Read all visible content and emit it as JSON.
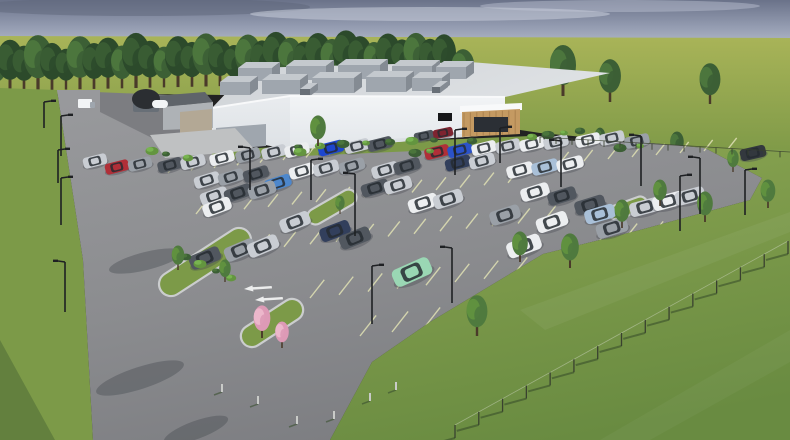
{
  "scene": {
    "type": "architectural-rendering",
    "description": "Aerial 3D rendering of a white single-story industrial building with rooftop HVAC units, a wood-clad entrance canopy, and a large landscaped parking lot filled with cars, surrounded by lawns, a tree line and fencing under an overcast blue-gray sky"
  },
  "palette": {
    "skyTop": "#6a7289",
    "skyMid": "#959db2",
    "skyHorizon": "#bac0cd",
    "cloudLight": "#c9cedb",
    "cloudDark": "#5d6579",
    "fieldLight": "#a9b458",
    "fieldMid": "#95a750",
    "fieldDark": "#7f9a48",
    "grassMid": "#7c9a48",
    "grassLight": "#8aa852",
    "hillTop": "#8aa451",
    "hillBottom": "#698b41",
    "grassShadow": "#4f6b36",
    "treeDark": "#2c4a2b",
    "treeMid": "#3c5f35",
    "treeLight": "#4f7a3e",
    "treeBright": "#63953f",
    "trunk": "#4a3a2a",
    "asphalt": "#8b8c8f",
    "asphaltLight": "#98999c",
    "asphaltDark": "#7c7d81",
    "curb": "#cbcdce",
    "stripe": "#dcddb2",
    "stripeWhite": "#eceded",
    "buildFront": "#f2f4f6",
    "buildFrontB": "#e2e6ea",
    "buildLeft": "#e9ecef",
    "buildLeftB": "#dde1e5",
    "roofA": "#cfd3d7",
    "roofB": "#dee1e4",
    "parapet": "#f8f9fa",
    "rtuFace": "#9fa6ae",
    "rtuTop": "#c4c9ce",
    "rtuSide": "#848b93",
    "rtuDark": "#686f77",
    "canopyWood": "#c49a62",
    "canopyWoodDark": "#a27a49",
    "glassDark": "#2b2f35",
    "signBlack": "#17181a",
    "domeDark": "#2b2e32",
    "annexGray": "#aeb2b6",
    "annexStone": "#b3a895",
    "annexRoof": "#5f646a",
    "padGray": "#bfc1c2",
    "pole": "#1e2023",
    "fence": "#39412f",
    "pinkLight": "#eebccf",
    "pinkMid": "#dd9ab6",
    "shadow": "#43464c"
  },
  "carColors": {
    "white": "#eceef0",
    "silver": "#c9cdd3",
    "gray": "#9aa0a7",
    "dkgray": "#51575f",
    "black": "#33383e",
    "navy": "#323f5c",
    "red": "#b02f38",
    "dkred": "#7e2430",
    "blue": "#2b52c8",
    "vividblue": "#1d46cf",
    "teal": "#4d87cc",
    "lightblue": "#a9c0d8",
    "mint": "#9ad7b4"
  },
  "building": {
    "rtus_back": [
      [
        238,
        68,
        34,
        13
      ],
      [
        286,
        66,
        40,
        14
      ],
      [
        338,
        65,
        42,
        14
      ],
      [
        392,
        66,
        40,
        14
      ],
      [
        436,
        67,
        30,
        12
      ]
    ],
    "rtus_front": [
      [
        220,
        82,
        30,
        13
      ],
      [
        262,
        80,
        38,
        14
      ],
      [
        312,
        78,
        42,
        15
      ],
      [
        366,
        77,
        40,
        15
      ],
      [
        412,
        78,
        30,
        13
      ]
    ],
    "vents": [
      [
        300,
        89,
        10,
        7
      ],
      [
        432,
        87,
        8,
        6
      ]
    ]
  },
  "parking": {
    "cars": [
      {
        "x": 95,
        "y": 161,
        "l": 24,
        "r": -14,
        "c": "silver"
      },
      {
        "x": 117,
        "y": 167,
        "l": 24,
        "r": -14,
        "c": "red"
      },
      {
        "x": 140,
        "y": 164,
        "l": 24,
        "r": -14,
        "c": "gray"
      },
      {
        "x": 170,
        "y": 165,
        "l": 25,
        "r": -15,
        "c": "dkgray"
      },
      {
        "x": 193,
        "y": 162,
        "l": 25,
        "r": -15,
        "c": "silver"
      },
      {
        "x": 222,
        "y": 158,
        "l": 25,
        "r": -15,
        "c": "white"
      },
      {
        "x": 248,
        "y": 155,
        "l": 25,
        "r": -15,
        "c": "gray"
      },
      {
        "x": 274,
        "y": 152,
        "l": 25,
        "r": -14,
        "c": "silver"
      },
      {
        "x": 297,
        "y": 150,
        "l": 25,
        "r": -14,
        "c": "white"
      },
      {
        "x": 331,
        "y": 148,
        "l": 26,
        "r": -14,
        "c": "vividblue"
      },
      {
        "x": 357,
        "y": 146,
        "l": 25,
        "r": -14,
        "c": "silver"
      },
      {
        "x": 380,
        "y": 144,
        "l": 25,
        "r": -14,
        "c": "dkgray"
      },
      {
        "x": 207,
        "y": 180,
        "l": 26,
        "r": -17,
        "c": "silver"
      },
      {
        "x": 231,
        "y": 177,
        "l": 26,
        "r": -17,
        "c": "gray"
      },
      {
        "x": 256,
        "y": 174,
        "l": 26,
        "r": -17,
        "c": "dkgray"
      },
      {
        "x": 278,
        "y": 183,
        "l": 27,
        "r": -18,
        "c": "teal"
      },
      {
        "x": 302,
        "y": 171,
        "l": 26,
        "r": -16,
        "c": "white"
      },
      {
        "x": 326,
        "y": 168,
        "l": 26,
        "r": -16,
        "c": "silver"
      },
      {
        "x": 352,
        "y": 166,
        "l": 26,
        "r": -16,
        "c": "gray"
      },
      {
        "x": 385,
        "y": 170,
        "l": 27,
        "r": -16,
        "c": "silver"
      },
      {
        "x": 407,
        "y": 166,
        "l": 27,
        "r": -16,
        "c": "dkgray"
      },
      {
        "x": 424,
        "y": 136,
        "l": 20,
        "r": -12,
        "c": "dkgray"
      },
      {
        "x": 443,
        "y": 133,
        "l": 20,
        "r": -12,
        "c": "dkred"
      },
      {
        "x": 437,
        "y": 152,
        "l": 25,
        "r": -14,
        "c": "red"
      },
      {
        "x": 460,
        "y": 150,
        "l": 25,
        "r": -14,
        "c": "blue"
      },
      {
        "x": 484,
        "y": 148,
        "l": 25,
        "r": -14,
        "c": "white"
      },
      {
        "x": 508,
        "y": 146,
        "l": 25,
        "r": -13,
        "c": "silver"
      },
      {
        "x": 532,
        "y": 144,
        "l": 25,
        "r": -13,
        "c": "white"
      },
      {
        "x": 556,
        "y": 142,
        "l": 25,
        "r": -13,
        "c": "silver"
      },
      {
        "x": 588,
        "y": 140,
        "l": 25,
        "r": -13,
        "c": "white"
      },
      {
        "x": 612,
        "y": 138,
        "l": 25,
        "r": -13,
        "c": "silver"
      },
      {
        "x": 637,
        "y": 141,
        "l": 25,
        "r": -13,
        "c": "gray"
      },
      {
        "x": 753,
        "y": 153,
        "l": 26,
        "r": -13,
        "c": "black"
      },
      {
        "x": 458,
        "y": 163,
        "l": 26,
        "r": -15,
        "c": "navy"
      },
      {
        "x": 482,
        "y": 161,
        "l": 26,
        "r": -15,
        "c": "silver"
      },
      {
        "x": 520,
        "y": 170,
        "l": 27,
        "r": -15,
        "c": "white"
      },
      {
        "x": 545,
        "y": 167,
        "l": 27,
        "r": -15,
        "c": "lightblue"
      },
      {
        "x": 570,
        "y": 164,
        "l": 27,
        "r": -15,
        "c": "white"
      },
      {
        "x": 214,
        "y": 196,
        "l": 28,
        "r": -19,
        "c": "silver"
      },
      {
        "x": 238,
        "y": 193,
        "l": 28,
        "r": -19,
        "c": "dkgray"
      },
      {
        "x": 217,
        "y": 207,
        "l": 29,
        "r": -20,
        "c": "white"
      },
      {
        "x": 262,
        "y": 190,
        "l": 28,
        "r": -18,
        "c": "gray"
      },
      {
        "x": 375,
        "y": 188,
        "l": 28,
        "r": -17,
        "c": "dkgray"
      },
      {
        "x": 398,
        "y": 185,
        "l": 28,
        "r": -17,
        "c": "silver"
      },
      {
        "x": 423,
        "y": 203,
        "l": 30,
        "r": -18,
        "c": "white"
      },
      {
        "x": 448,
        "y": 199,
        "l": 30,
        "r": -18,
        "c": "silver"
      },
      {
        "x": 535,
        "y": 192,
        "l": 29,
        "r": -17,
        "c": "white"
      },
      {
        "x": 562,
        "y": 196,
        "l": 29,
        "r": -17,
        "c": "dkgray"
      },
      {
        "x": 590,
        "y": 205,
        "l": 31,
        "r": -17,
        "c": "dkgray"
      },
      {
        "x": 505,
        "y": 215,
        "l": 31,
        "r": -18,
        "c": "gray"
      },
      {
        "x": 552,
        "y": 222,
        "l": 32,
        "r": -19,
        "c": "white"
      },
      {
        "x": 600,
        "y": 214,
        "l": 31,
        "r": -16,
        "c": "lightblue"
      },
      {
        "x": 612,
        "y": 228,
        "l": 32,
        "r": -17,
        "c": "gray"
      },
      {
        "x": 645,
        "y": 207,
        "l": 31,
        "r": -15,
        "c": "silver"
      },
      {
        "x": 668,
        "y": 201,
        "l": 31,
        "r": -15,
        "c": "white"
      },
      {
        "x": 690,
        "y": 196,
        "l": 30,
        "r": -15,
        "c": "silver"
      },
      {
        "x": 205,
        "y": 258,
        "l": 32,
        "r": -23,
        "c": "dkgray"
      },
      {
        "x": 240,
        "y": 250,
        "l": 32,
        "r": -23,
        "c": "gray"
      },
      {
        "x": 263,
        "y": 246,
        "l": 32,
        "r": -23,
        "c": "silver"
      },
      {
        "x": 295,
        "y": 222,
        "l": 31,
        "r": -21,
        "c": "silver"
      },
      {
        "x": 335,
        "y": 231,
        "l": 31,
        "r": -21,
        "c": "navy"
      },
      {
        "x": 355,
        "y": 238,
        "l": 32,
        "r": -22,
        "c": "dkgray"
      },
      {
        "x": 524,
        "y": 246,
        "l": 35,
        "r": -20,
        "c": "white"
      },
      {
        "x": 412,
        "y": 272,
        "l": 40,
        "r": -24,
        "c": "mint"
      }
    ],
    "stripe_rows": [
      {
        "x": 168,
        "y": 173,
        "n": 10,
        "dx": 23,
        "dy": -2.6,
        "len": 13
      },
      {
        "x": 196,
        "y": 214,
        "n": 14,
        "dx": 24,
        "dy": -2.4,
        "len": 16
      },
      {
        "x": 232,
        "y": 252,
        "n": 13,
        "dx": 26,
        "dy": -2.6,
        "len": 19
      },
      {
        "x": 310,
        "y": 298,
        "n": 9,
        "dx": 29,
        "dy": -3.2,
        "len": 23
      },
      {
        "x": 360,
        "y": 336,
        "n": 5,
        "dx": 32,
        "dy": -4,
        "len": 26
      },
      {
        "x": 560,
        "y": 163,
        "n": 8,
        "dx": 24,
        "dy": -2,
        "len": 14
      },
      {
        "x": 600,
        "y": 240,
        "n": 6,
        "dx": 26,
        "dy": -2.2,
        "len": 18
      }
    ],
    "arrows": [
      {
        "x": 244,
        "y": 289
      },
      {
        "x": 255,
        "y": 300
      }
    ],
    "islands": [
      {
        "x": 205,
        "y": 262,
        "w": 105,
        "h": 24,
        "rot": -33
      },
      {
        "x": 272,
        "y": 323,
        "w": 70,
        "h": 22,
        "rot": -33
      },
      {
        "x": 332,
        "y": 207,
        "w": 54,
        "h": 16,
        "rot": -30
      },
      {
        "x": 628,
        "y": 208,
        "w": 40,
        "h": 14,
        "rot": -20
      }
    ]
  },
  "scenery": {
    "treeline": [
      [
        -4,
        42
      ],
      [
        10,
        50
      ],
      [
        24,
        44
      ],
      [
        38,
        54
      ],
      [
        52,
        46
      ],
      [
        66,
        40
      ],
      [
        80,
        52
      ],
      [
        94,
        45
      ],
      [
        108,
        50
      ],
      [
        122,
        42
      ],
      [
        136,
        54
      ],
      [
        150,
        46
      ],
      [
        164,
        40
      ],
      [
        178,
        50
      ],
      [
        192,
        44
      ],
      [
        206,
        52
      ],
      [
        220,
        46
      ],
      [
        234,
        40
      ],
      [
        248,
        50
      ],
      [
        262,
        44
      ],
      [
        276,
        52
      ],
      [
        290,
        46
      ],
      [
        304,
        42
      ],
      [
        318,
        50
      ],
      [
        332,
        44
      ],
      [
        346,
        52
      ],
      [
        360,
        46
      ],
      [
        374,
        40
      ],
      [
        388,
        48
      ],
      [
        402,
        42
      ],
      [
        416,
        48
      ],
      [
        430,
        42
      ],
      [
        444,
        46
      ]
    ],
    "right_trees": [
      [
        463,
        94,
        44
      ],
      [
        563,
        96,
        50
      ],
      [
        610,
        102,
        42
      ],
      [
        710,
        104,
        40
      ]
    ],
    "hill_trees": [
      [
        600,
        148,
        20
      ],
      [
        677,
        158,
        26
      ],
      [
        757,
        178,
        28
      ]
    ],
    "lot_trees": [
      [
        318,
        146,
        30
      ],
      [
        178,
        270,
        24
      ],
      [
        225,
        282,
        22
      ],
      [
        340,
        214,
        18
      ],
      [
        477,
        336,
        40
      ],
      [
        570,
        268,
        34
      ],
      [
        622,
        228,
        28
      ],
      [
        660,
        206,
        26
      ],
      [
        705,
        222,
        30
      ],
      [
        733,
        172,
        22
      ],
      [
        768,
        208,
        28
      ],
      [
        520,
        262,
        30
      ]
    ],
    "pink_trees": [
      [
        262,
        338,
        32
      ],
      [
        282,
        348,
        26
      ]
    ],
    "bushes": [
      [
        298,
        147
      ],
      [
        320,
        146
      ],
      [
        343,
        144
      ],
      [
        366,
        143
      ],
      [
        390,
        142
      ],
      [
        412,
        141
      ],
      [
        434,
        140
      ],
      [
        532,
        137
      ],
      [
        548,
        135
      ],
      [
        564,
        133
      ],
      [
        580,
        131
      ],
      [
        152,
        151
      ],
      [
        166,
        154
      ],
      [
        188,
        158
      ],
      [
        415,
        153
      ],
      [
        430,
        151
      ],
      [
        186,
        257
      ],
      [
        200,
        264
      ],
      [
        216,
        271
      ],
      [
        231,
        278
      ],
      [
        620,
        148
      ],
      [
        640,
        146
      ],
      [
        472,
        141
      ],
      [
        300,
        152
      ]
    ],
    "poles": [
      {
        "x": 44,
        "y": 102,
        "h": 26,
        "d": 1
      },
      {
        "x": 61,
        "y": 116,
        "h": 40,
        "d": 1
      },
      {
        "x": 58,
        "y": 150,
        "h": 33,
        "d": 1
      },
      {
        "x": 61,
        "y": 178,
        "h": 47,
        "d": 1
      },
      {
        "x": 65,
        "y": 262,
        "h": 50,
        "d": -1
      },
      {
        "x": 250,
        "y": 148,
        "h": 42,
        "d": -1
      },
      {
        "x": 311,
        "y": 160,
        "h": 40,
        "d": 1
      },
      {
        "x": 355,
        "y": 174,
        "h": 62,
        "d": -1
      },
      {
        "x": 455,
        "y": 130,
        "h": 45,
        "d": 1
      },
      {
        "x": 561,
        "y": 141,
        "h": 46,
        "d": -1
      },
      {
        "x": 372,
        "y": 266,
        "h": 58,
        "d": 1
      },
      {
        "x": 452,
        "y": 248,
        "h": 55,
        "d": -1
      },
      {
        "x": 500,
        "y": 128,
        "h": 35,
        "d": 1
      },
      {
        "x": 641,
        "y": 136,
        "h": 50,
        "d": -1
      },
      {
        "x": 680,
        "y": 176,
        "h": 55,
        "d": 1
      },
      {
        "x": 700,
        "y": 158,
        "h": 56,
        "d": -1
      },
      {
        "x": 745,
        "y": 170,
        "h": 45,
        "d": 1
      }
    ],
    "hill_fence": {
      "x1": 540,
      "y1": 137,
      "x2": 790,
      "y2": 152,
      "post_gap": 16,
      "post_h": 6
    },
    "front_fence": {
      "x1": 455,
      "y1": 438,
      "x2": 788,
      "y2": 254,
      "posts": 15,
      "post_h": 13
    },
    "stakes": [
      [
        222,
        392
      ],
      [
        258,
        404
      ],
      [
        297,
        424
      ],
      [
        334,
        419
      ],
      [
        370,
        401
      ],
      [
        396,
        390
      ]
    ],
    "road_shadows": [
      [
        140,
        378,
        46,
        11,
        -18
      ],
      [
        146,
        261,
        38,
        9,
        -14
      ],
      [
        196,
        430,
        34,
        9,
        -20
      ]
    ]
  }
}
